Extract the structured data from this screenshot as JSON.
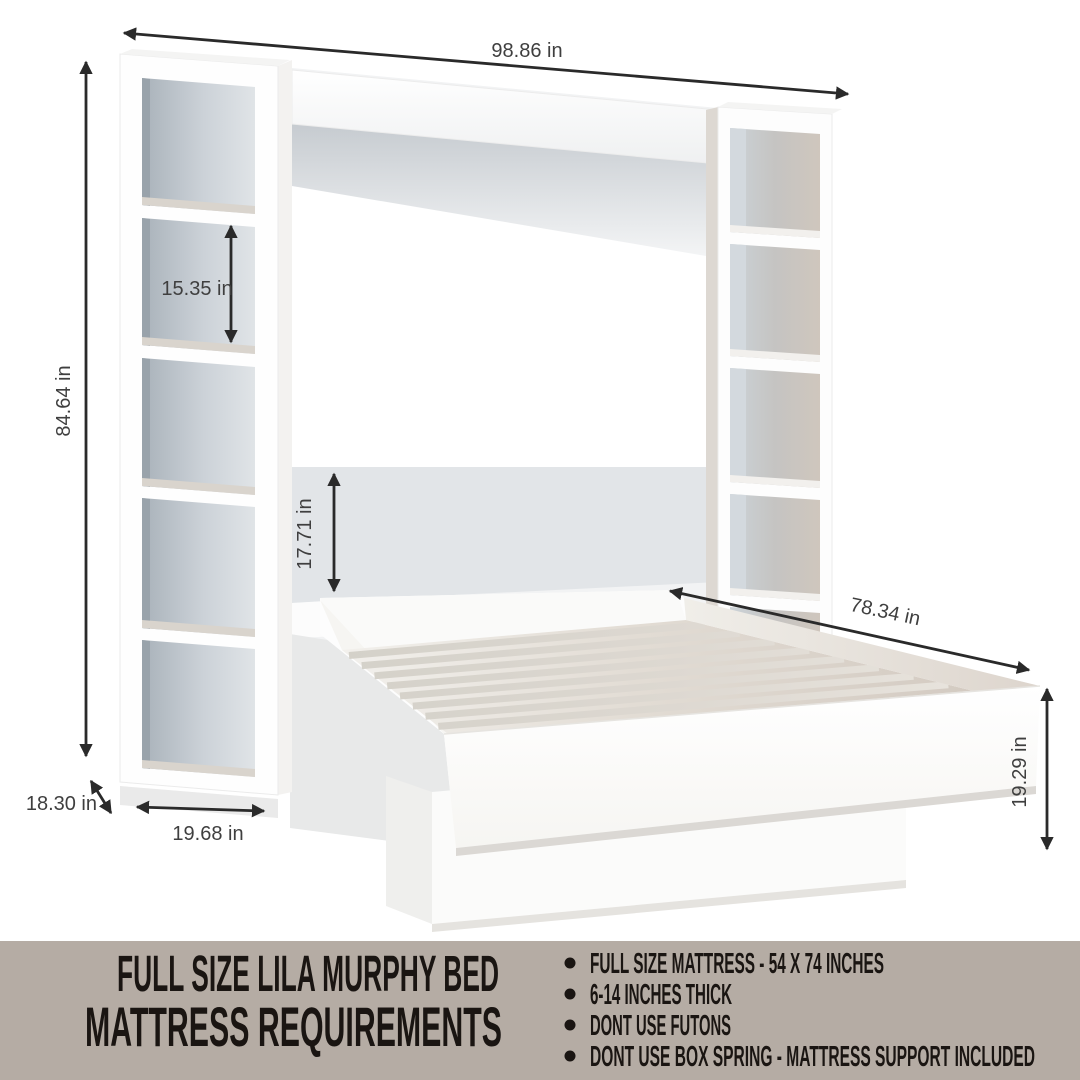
{
  "dimensions": {
    "overall_width": "98.86 in",
    "overall_height": "84.64 in",
    "shelf_cubby_height": "15.35 in",
    "headboard_panel_height": "17.71 in",
    "bed_length": "78.34 in",
    "bed_frame_height": "19.29 in",
    "shelf_tower_depth": "18.30 in",
    "shelf_tower_width": "19.68 in"
  },
  "banner": {
    "title_line1": "FULL SIZE LILA MURPHY BED",
    "title_line2": "MATTRESS REQUIREMENTS",
    "bullets": [
      "FULL SIZE MATTRESS - 54 X 74 INCHES",
      "6-14 INCHES THICK",
      "DONT USE FUTONS",
      "DONT USE BOX SPRING - MATTRESS SUPPORT INCLUDED"
    ],
    "background": "#b5aca4",
    "text_color": "#1a1512"
  },
  "colors": {
    "arrow": "#2a2a2a",
    "dim_text": "#3f3f3f",
    "wall_panel": "#f2f3f4",
    "gray_band": "#e2e5e8",
    "deck_warm": "#d5ccc3",
    "cubby_cool": "#c9d0d6",
    "cubby_warm": "#cfc6bd"
  }
}
